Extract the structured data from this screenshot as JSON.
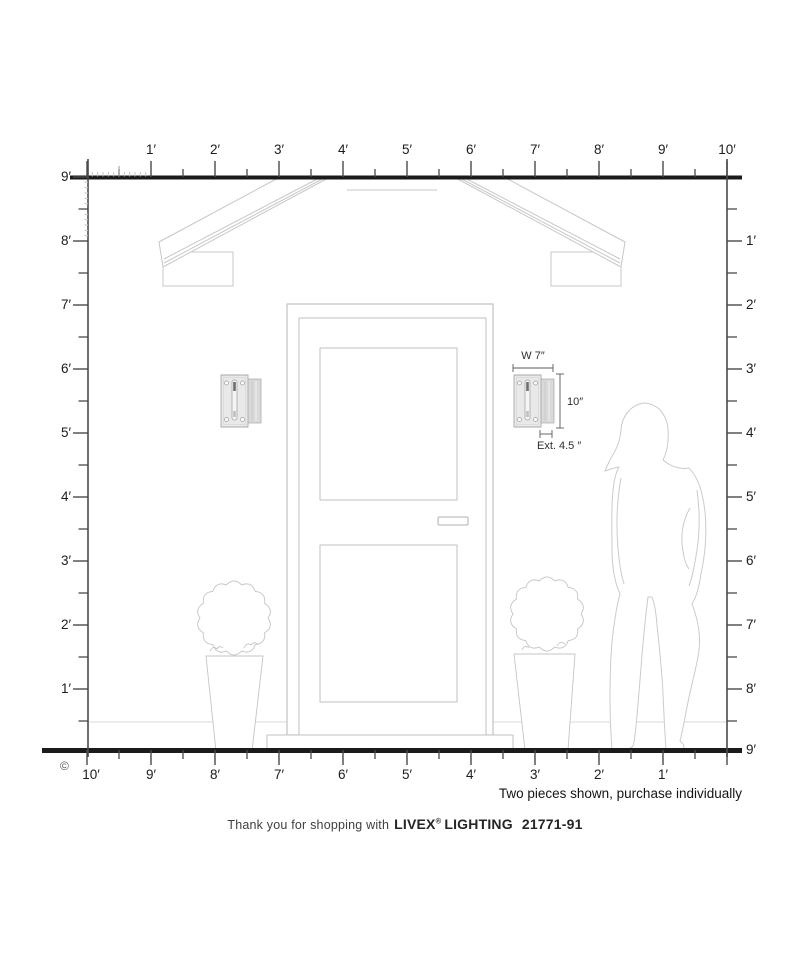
{
  "scale_rulers": {
    "top": {
      "labels": [
        "1′",
        "2′",
        "3′",
        "4′",
        "5′",
        "6′",
        "7′",
        "8′",
        "9′",
        "10′"
      ]
    },
    "left": {
      "labels": [
        "9′",
        "8′",
        "7′",
        "6′",
        "5′",
        "4′",
        "3′",
        "2′",
        "1′"
      ]
    },
    "right": {
      "labels": [
        "1′",
        "2′",
        "3′",
        "4′",
        "5′",
        "6′",
        "7′",
        "8′",
        "9′"
      ]
    },
    "bottom": {
      "labels": [
        "10′",
        "9′",
        "8′",
        "7′",
        "6′",
        "5′",
        "4′",
        "3′",
        "2′",
        "1′"
      ]
    }
  },
  "product_dimensions": {
    "width": "W 7″",
    "height": "10″",
    "extension": "Ext. 4.5 ″"
  },
  "notes": {
    "purchase_note": "Two pieces shown, purchase individually",
    "copyright_symbol": "©"
  },
  "footer": {
    "thanks_text": "Thank you for shopping with",
    "brand_name": "LIVEX",
    "registered_mark": "®",
    "brand_suffix": "LIGHTING",
    "model_number": "21771-91"
  }
}
